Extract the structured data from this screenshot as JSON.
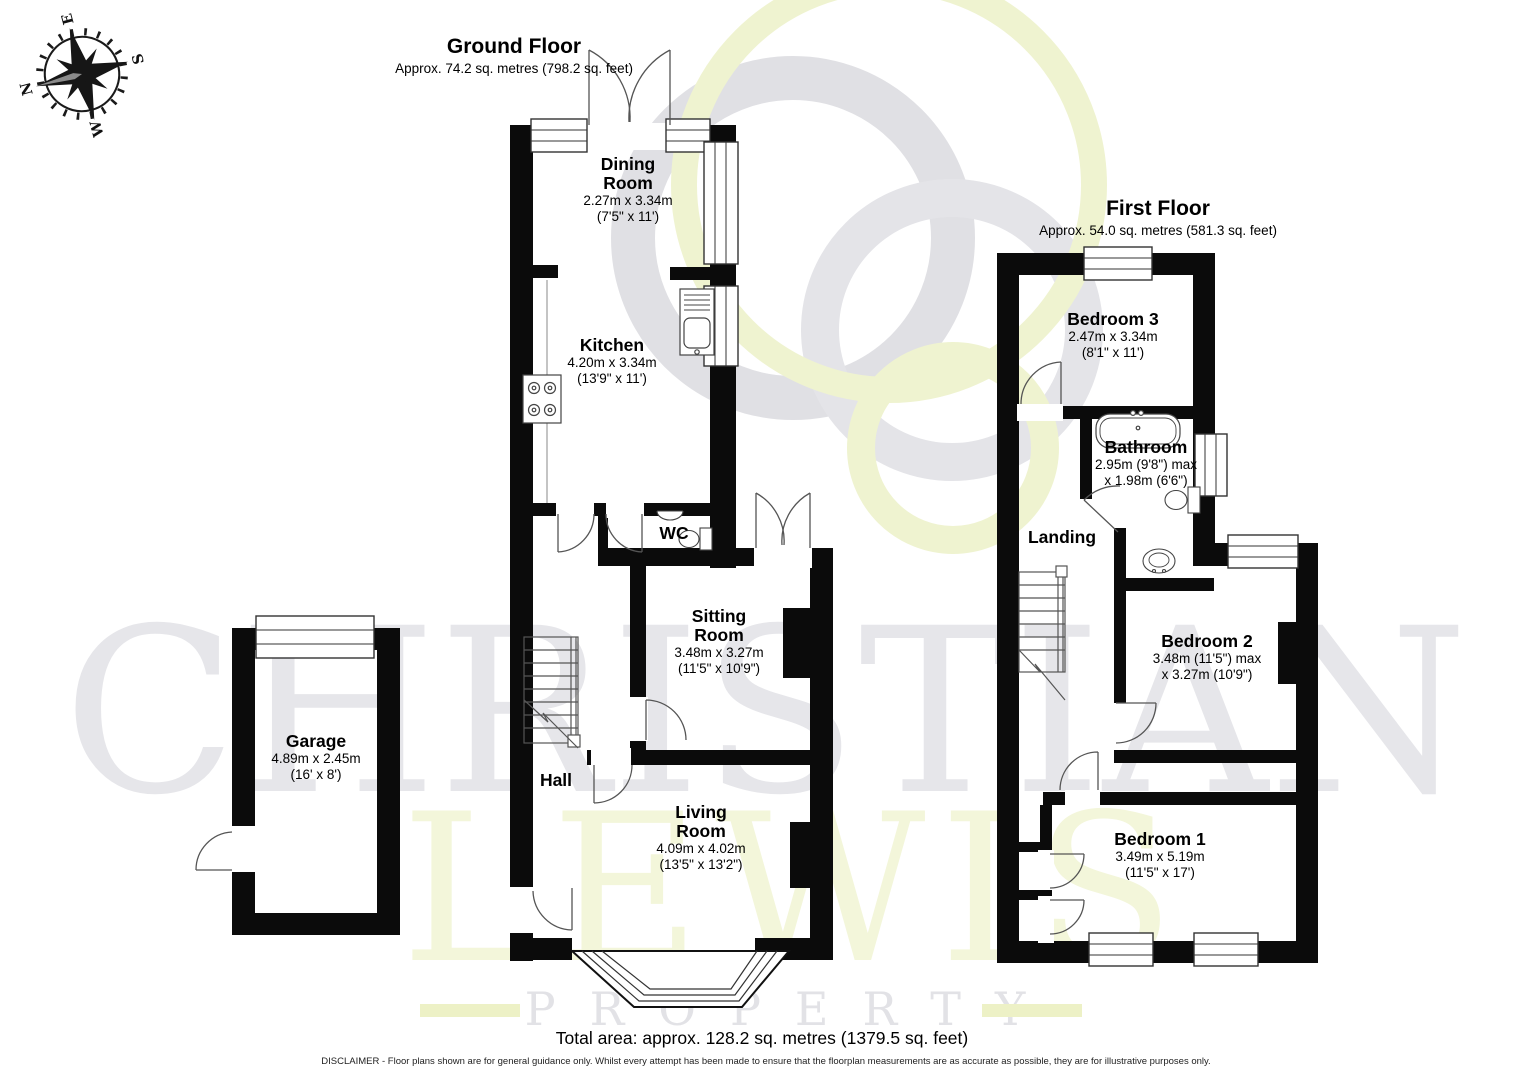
{
  "compass": {
    "n": "N",
    "e": "E",
    "s": "S",
    "w": "W"
  },
  "watermark": {
    "word1": "CHRISTIAN",
    "word2": "LEWIS",
    "word3": "PROPERTY"
  },
  "ground_floor": {
    "title": "Ground Floor",
    "subtitle": "Approx. 74.2 sq. metres (798.2 sq. feet)",
    "rooms": {
      "dining": {
        "name": "Dining Room",
        "d1": "2.27m x 3.34m",
        "d2": "(7'5\" x 11')"
      },
      "kitchen": {
        "name": "Kitchen",
        "d1": "4.20m x 3.34m",
        "d2": "(13'9\" x 11')"
      },
      "wc": {
        "name": "WC"
      },
      "sitting": {
        "name": "Sitting Room",
        "d1": "3.48m x 3.27m",
        "d2": "(11'5\" x 10'9\")"
      },
      "hall": {
        "name": "Hall"
      },
      "living": {
        "name": "Living Room",
        "d1": "4.09m x 4.02m",
        "d2": "(13'5\" x 13'2\")"
      }
    }
  },
  "garage": {
    "name": "Garage",
    "d1": "4.89m x 2.45m",
    "d2": "(16' x 8')"
  },
  "first_floor": {
    "title": "First Floor",
    "subtitle": "Approx. 54.0 sq. metres (581.3 sq. feet)",
    "rooms": {
      "bedroom3": {
        "name": "Bedroom 3",
        "d1": "2.47m x 3.34m",
        "d2": "(8'1\" x 11')"
      },
      "bathroom": {
        "name": "Bathroom",
        "d1": "2.95m (9'8\") max",
        "d2": "x 1.98m (6'6\")"
      },
      "landing": {
        "name": "Landing"
      },
      "bedroom2": {
        "name": "Bedroom 2",
        "d1": "3.48m (11'5\") max",
        "d2": "x 3.27m (10'9\")"
      },
      "bedroom1": {
        "name": "Bedroom 1",
        "d1": "3.49m x 5.19m",
        "d2": "(11'5\" x 17')"
      }
    }
  },
  "footer": {
    "total": "Total area: approx. 128.2 sq. metres (1379.5 sq. feet)",
    "disclaimer": "DISCLAIMER -  Floor plans shown are for general guidance only. Whilst every attempt has been made to ensure that the floorplan measurements are as accurate as possible, they are for illustrative purposes only."
  }
}
